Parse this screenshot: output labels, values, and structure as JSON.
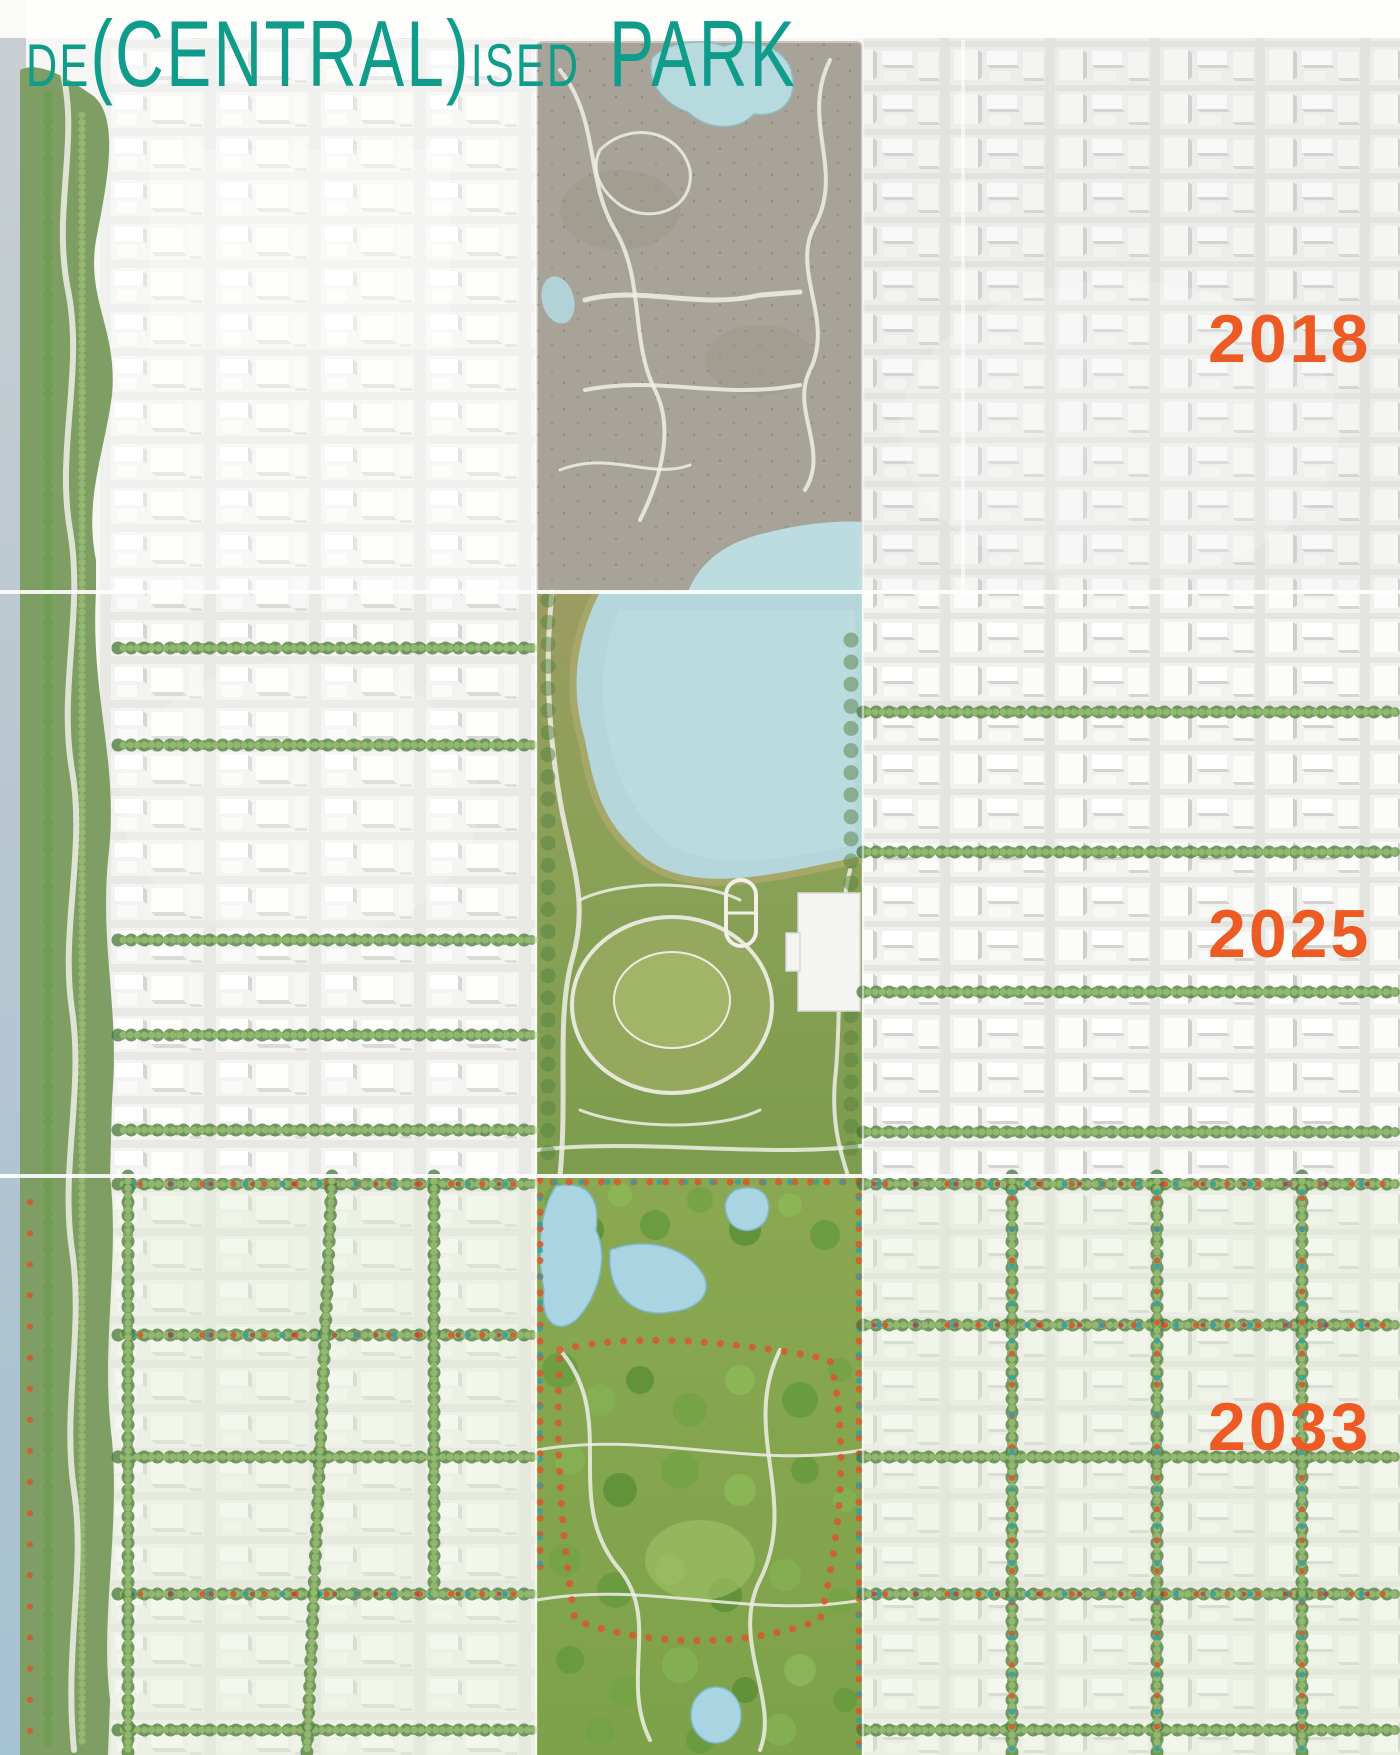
{
  "title": {
    "part1": "DE",
    "part2": "(CENTRAL)",
    "part3": "ISED",
    "part4": "PARK"
  },
  "years": {
    "y2018": "2018",
    "y2025": "2025",
    "y2033": "2033"
  },
  "colors": {
    "title_teal": "#0f9c8b",
    "year_orange": "#ee5a24",
    "park_2018_grey": "#a7a399",
    "park_2025_olive": "#89a156",
    "park_2033_green": "#7da24a",
    "reservoir_blue": "#b5d7db",
    "lake_blue": "#a9d4e2"
  }
}
